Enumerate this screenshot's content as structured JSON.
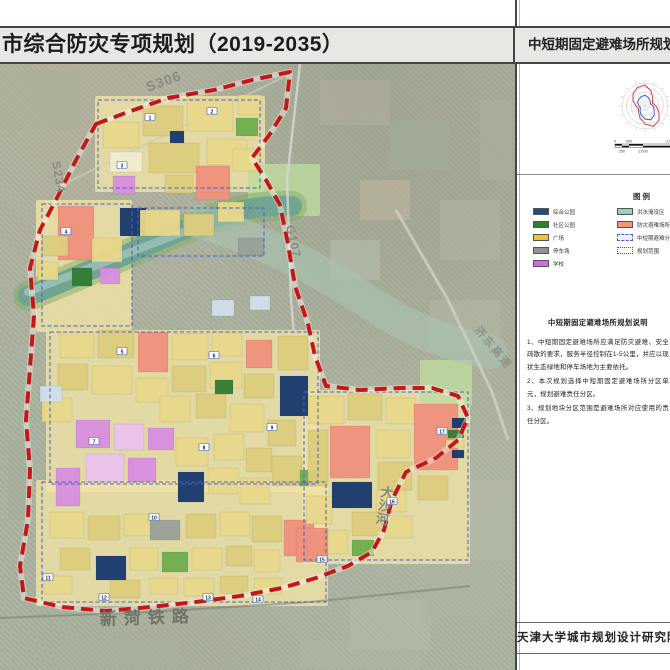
{
  "title_bar": {
    "left_title": "市综合防灾专项规划（2019-2035）",
    "right_title": "中短期固定避难场所规划图"
  },
  "panel": {
    "legend": {
      "heading": "图例",
      "left_items": [
        {
          "label": "综合公园",
          "color": "#1c4f7e",
          "type": "fill"
        },
        {
          "label": "社区公园",
          "color": "#2e7d32",
          "type": "fill"
        },
        {
          "label": "广场",
          "color": "#f2c330",
          "type": "fill"
        },
        {
          "label": "停车场",
          "color": "#8d948c",
          "type": "fill"
        },
        {
          "label": "学校",
          "color": "#d66ae6",
          "type": "fill"
        }
      ],
      "right_items": [
        {
          "label": "洪水淹没区",
          "color": "#93d4bb",
          "type": "fill"
        },
        {
          "label": "防灾避难场所",
          "color": "#f29579",
          "type": "fill"
        },
        {
          "label": "中短期避难分区",
          "color": "#eef4fb",
          "type": "dashed-blue"
        },
        {
          "label": "规划范围",
          "color": "#ffffff",
          "type": "dashed-red"
        }
      ]
    },
    "notes": {
      "heading": "中短期固定避难场所规划说明",
      "items": [
        "1、中短期固定避难场所应满足防灾避难、安全疏散的要求，服务半径控制在1-5公里，并应以现状生态绿地和停车场地为主要依托。",
        "2、本次规划选择中短期固定避难场所分区单元，规划避难责任分区。",
        "3、规划地块分区范围是避难场所对应使用的责任分区。"
      ]
    },
    "scale_bar": {
      "top_labels": [
        "0",
        "500",
        "2,000"
      ],
      "bottom_labels": [
        "250",
        "1,000"
      ],
      "tick_values_m": [
        0,
        250,
        500,
        1000,
        2000
      ]
    },
    "wind_rose": {
      "name": "风玫瑰"
    },
    "footer": "天津大学城市规划设计研究院"
  },
  "map": {
    "accent_boundary_color": "#c41818",
    "unit_outline_color": "#4a5fc4",
    "palette": {
      "y": "#e9d88a",
      "y2": "#f0e3a6",
      "y3": "#ddcd7e",
      "c": "#f2ecd2",
      "s": "#f0917c",
      "v": "#d88fe0",
      "p": "#eac2ec",
      "g": "#2f7d33",
      "g2": "#6fae4e",
      "gl": "#bedb9e",
      "n": "#17386e",
      "b": "#cfe0ee",
      "gr": "#99a198",
      "t": "#8fd4bb"
    },
    "road_labels": [
      {
        "text": "S306",
        "x": 148,
        "y": 92,
        "rot": -20,
        "size": 14,
        "color": "#8a8a82",
        "ls": 1
      },
      {
        "text": "S234",
        "x": 52,
        "y": 162,
        "rot": 80,
        "size": 12,
        "color": "#8a8a82",
        "ls": 1
      },
      {
        "text": "G107",
        "x": 286,
        "y": 226,
        "rot": 78,
        "size": 12,
        "color": "#8a8a82",
        "ls": 1
      },
      {
        "text": "济东高速",
        "x": 474,
        "y": 330,
        "rot": 50,
        "size": 11,
        "color": "#90948a",
        "ls": 2
      },
      {
        "text": "大沙河",
        "x": 380,
        "y": 496,
        "rot": 10,
        "size": 13,
        "color": "#84887e",
        "vertical": true
      },
      {
        "text": "新菏铁路",
        "x": 100,
        "y": 625,
        "rot": -2,
        "size": 17,
        "color": "#6f7368",
        "ls": 7
      }
    ],
    "site_numbers": [
      {
        "n": "1",
        "x": 150,
        "y": 118
      },
      {
        "n": "2",
        "x": 212,
        "y": 112
      },
      {
        "n": "3",
        "x": 122,
        "y": 166
      },
      {
        "n": "4",
        "x": 66,
        "y": 232
      },
      {
        "n": "5",
        "x": 122,
        "y": 352
      },
      {
        "n": "6",
        "x": 214,
        "y": 356
      },
      {
        "n": "7",
        "x": 94,
        "y": 442
      },
      {
        "n": "8",
        "x": 204,
        "y": 448
      },
      {
        "n": "9",
        "x": 272,
        "y": 428
      },
      {
        "n": "10",
        "x": 154,
        "y": 518
      },
      {
        "n": "11",
        "x": 48,
        "y": 578
      },
      {
        "n": "12",
        "x": 104,
        "y": 598
      },
      {
        "n": "13",
        "x": 208,
        "y": 598
      },
      {
        "n": "14",
        "x": 258,
        "y": 600
      },
      {
        "n": "15",
        "x": 322,
        "y": 560
      },
      {
        "n": "16",
        "x": 392,
        "y": 502
      },
      {
        "n": "17",
        "x": 442,
        "y": 432
      }
    ],
    "zones": [
      [
        95,
        96,
        170,
        96,
        "y2"
      ],
      [
        36,
        200,
        96,
        132,
        "y2"
      ],
      [
        46,
        330,
        274,
        162,
        "y2"
      ],
      [
        36,
        480,
        292,
        126,
        "y2"
      ],
      [
        302,
        390,
        168,
        174,
        "y2"
      ],
      [
        248,
        164,
        72,
        52,
        "gl"
      ],
      [
        420,
        360,
        52,
        46,
        "gl"
      ]
    ],
    "parcels": [
      [
        103,
        122,
        36,
        26,
        "y"
      ],
      [
        143,
        106,
        40,
        30,
        "y3"
      ],
      [
        187,
        99,
        46,
        32,
        "y"
      ],
      [
        207,
        139,
        40,
        26,
        "y"
      ],
      [
        149,
        143,
        50,
        30,
        "y3"
      ],
      [
        110,
        152,
        32,
        20,
        "c"
      ],
      [
        196,
        166,
        34,
        34,
        "s"
      ],
      [
        113,
        176,
        22,
        18,
        "v"
      ],
      [
        236,
        118,
        22,
        18,
        "g2"
      ],
      [
        170,
        131,
        14,
        12,
        "n"
      ],
      [
        233,
        149,
        28,
        22,
        "y"
      ],
      [
        165,
        175,
        28,
        18,
        "y3"
      ],
      [
        238,
        95,
        24,
        20,
        "y"
      ],
      [
        58,
        206,
        36,
        54,
        "s"
      ],
      [
        120,
        208,
        26,
        28,
        "n"
      ],
      [
        92,
        238,
        30,
        24,
        "y"
      ],
      [
        72,
        268,
        20,
        18,
        "g"
      ],
      [
        100,
        268,
        20,
        16,
        "v"
      ],
      [
        42,
        236,
        26,
        20,
        "y3"
      ],
      [
        38,
        262,
        20,
        18,
        "y"
      ],
      [
        140,
        210,
        40,
        26,
        "y"
      ],
      [
        184,
        214,
        30,
        22,
        "y3"
      ],
      [
        218,
        202,
        26,
        20,
        "y"
      ],
      [
        238,
        238,
        26,
        18,
        "gr"
      ],
      [
        212,
        300,
        22,
        16,
        "b"
      ],
      [
        250,
        296,
        20,
        14,
        "b"
      ],
      [
        60,
        332,
        34,
        26,
        "y"
      ],
      [
        98,
        330,
        36,
        28,
        "y3"
      ],
      [
        138,
        332,
        30,
        40,
        "s"
      ],
      [
        172,
        334,
        36,
        26,
        "y"
      ],
      [
        212,
        332,
        30,
        24,
        "y"
      ],
      [
        246,
        340,
        26,
        28,
        "s"
      ],
      [
        278,
        336,
        30,
        34,
        "y3"
      ],
      [
        58,
        364,
        30,
        26,
        "y3"
      ],
      [
        92,
        366,
        40,
        28,
        "y"
      ],
      [
        136,
        378,
        32,
        24,
        "y"
      ],
      [
        172,
        366,
        34,
        26,
        "y3"
      ],
      [
        210,
        362,
        32,
        26,
        "y"
      ],
      [
        244,
        374,
        30,
        24,
        "y3"
      ],
      [
        280,
        376,
        28,
        40,
        "n"
      ],
      [
        42,
        398,
        30,
        24,
        "y"
      ],
      [
        40,
        386,
        22,
        16,
        "b"
      ],
      [
        160,
        396,
        30,
        26,
        "y"
      ],
      [
        196,
        394,
        30,
        24,
        "y3"
      ],
      [
        230,
        404,
        34,
        28,
        "y"
      ],
      [
        268,
        420,
        28,
        26,
        "y3"
      ],
      [
        214,
        434,
        30,
        26,
        "y"
      ],
      [
        246,
        448,
        26,
        24,
        "y3"
      ],
      [
        176,
        438,
        32,
        28,
        "y"
      ],
      [
        76,
        420,
        34,
        28,
        "v"
      ],
      [
        114,
        424,
        30,
        26,
        "p"
      ],
      [
        148,
        428,
        26,
        22,
        "v"
      ],
      [
        86,
        454,
        38,
        28,
        "p"
      ],
      [
        128,
        458,
        28,
        24,
        "v"
      ],
      [
        56,
        468,
        24,
        38,
        "v"
      ],
      [
        178,
        472,
        26,
        30,
        "n"
      ],
      [
        208,
        468,
        30,
        26,
        "y"
      ],
      [
        240,
        478,
        30,
        26,
        "y"
      ],
      [
        272,
        456,
        30,
        30,
        "y3"
      ],
      [
        300,
        470,
        18,
        16,
        "g2"
      ],
      [
        215,
        380,
        18,
        14,
        "g"
      ],
      [
        50,
        512,
        34,
        26,
        "y"
      ],
      [
        88,
        516,
        32,
        24,
        "y3"
      ],
      [
        124,
        514,
        30,
        22,
        "y"
      ],
      [
        150,
        520,
        30,
        20,
        "gr"
      ],
      [
        186,
        514,
        30,
        24,
        "y3"
      ],
      [
        220,
        512,
        30,
        24,
        "y"
      ],
      [
        252,
        516,
        30,
        26,
        "y3"
      ],
      [
        284,
        520,
        30,
        36,
        "s"
      ],
      [
        96,
        556,
        30,
        24,
        "n"
      ],
      [
        60,
        548,
        30,
        22,
        "y3"
      ],
      [
        130,
        548,
        28,
        22,
        "y"
      ],
      [
        162,
        552,
        26,
        20,
        "g2"
      ],
      [
        192,
        548,
        30,
        22,
        "y"
      ],
      [
        226,
        546,
        26,
        20,
        "y3"
      ],
      [
        254,
        550,
        26,
        22,
        "y"
      ],
      [
        44,
        576,
        28,
        18,
        "y"
      ],
      [
        110,
        580,
        30,
        18,
        "y3"
      ],
      [
        150,
        578,
        28,
        16,
        "y"
      ],
      [
        184,
        578,
        30,
        18,
        "y"
      ],
      [
        220,
        576,
        28,
        18,
        "y3"
      ],
      [
        254,
        578,
        28,
        16,
        "y"
      ],
      [
        308,
        396,
        36,
        28,
        "y"
      ],
      [
        348,
        394,
        34,
        26,
        "y3"
      ],
      [
        386,
        398,
        30,
        26,
        "y"
      ],
      [
        330,
        426,
        40,
        52,
        "s"
      ],
      [
        376,
        430,
        34,
        28,
        "y"
      ],
      [
        414,
        404,
        44,
        66,
        "s"
      ],
      [
        418,
        476,
        30,
        24,
        "y3"
      ],
      [
        378,
        462,
        34,
        28,
        "y3"
      ],
      [
        332,
        482,
        40,
        26,
        "n"
      ],
      [
        376,
        490,
        30,
        22,
        "y"
      ],
      [
        308,
        430,
        20,
        56,
        "y3"
      ],
      [
        306,
        496,
        26,
        28,
        "y"
      ],
      [
        352,
        512,
        30,
        24,
        "y3"
      ],
      [
        318,
        530,
        30,
        24,
        "y"
      ],
      [
        384,
        516,
        28,
        22,
        "y"
      ],
      [
        352,
        540,
        22,
        16,
        "g2"
      ],
      [
        296,
        528,
        32,
        34,
        "s"
      ],
      [
        452,
        418,
        14,
        10,
        "n"
      ],
      [
        448,
        430,
        16,
        8,
        "g"
      ],
      [
        446,
        440,
        18,
        8,
        "y"
      ],
      [
        452,
        450,
        12,
        8,
        "n"
      ]
    ],
    "dashed_blocks": [
      [
        98,
        100,
        162,
        88
      ],
      [
        42,
        204,
        90,
        122
      ],
      [
        138,
        208,
        126,
        48
      ],
      [
        50,
        332,
        268,
        152
      ],
      [
        42,
        482,
        284,
        120
      ],
      [
        304,
        392,
        164,
        168
      ]
    ],
    "fields": [
      [
        320,
        80,
        70,
        45,
        "#b5ac9b"
      ],
      [
        390,
        120,
        60,
        50,
        "#a3ad97"
      ],
      [
        440,
        200,
        60,
        60,
        "#aeb6a4"
      ],
      [
        360,
        180,
        50,
        40,
        "#c1b6a2"
      ],
      [
        430,
        300,
        70,
        50,
        "#b0b8a6"
      ],
      [
        350,
        600,
        80,
        50,
        "#b4bba8"
      ],
      [
        420,
        560,
        80,
        60,
        "#adb49f"
      ],
      [
        0,
        70,
        80,
        60,
        "#a7b098"
      ],
      [
        8,
        440,
        22,
        80,
        "#a5ae9a"
      ],
      [
        300,
        640,
        120,
        28,
        "#b0b7a4"
      ],
      [
        60,
        640,
        120,
        25,
        "#aab29e"
      ],
      [
        470,
        480,
        42,
        80,
        "#b6bcaa"
      ],
      [
        480,
        100,
        32,
        80,
        "#a9b19d"
      ],
      [
        330,
        240,
        50,
        40,
        "#b7bfae"
      ]
    ]
  }
}
